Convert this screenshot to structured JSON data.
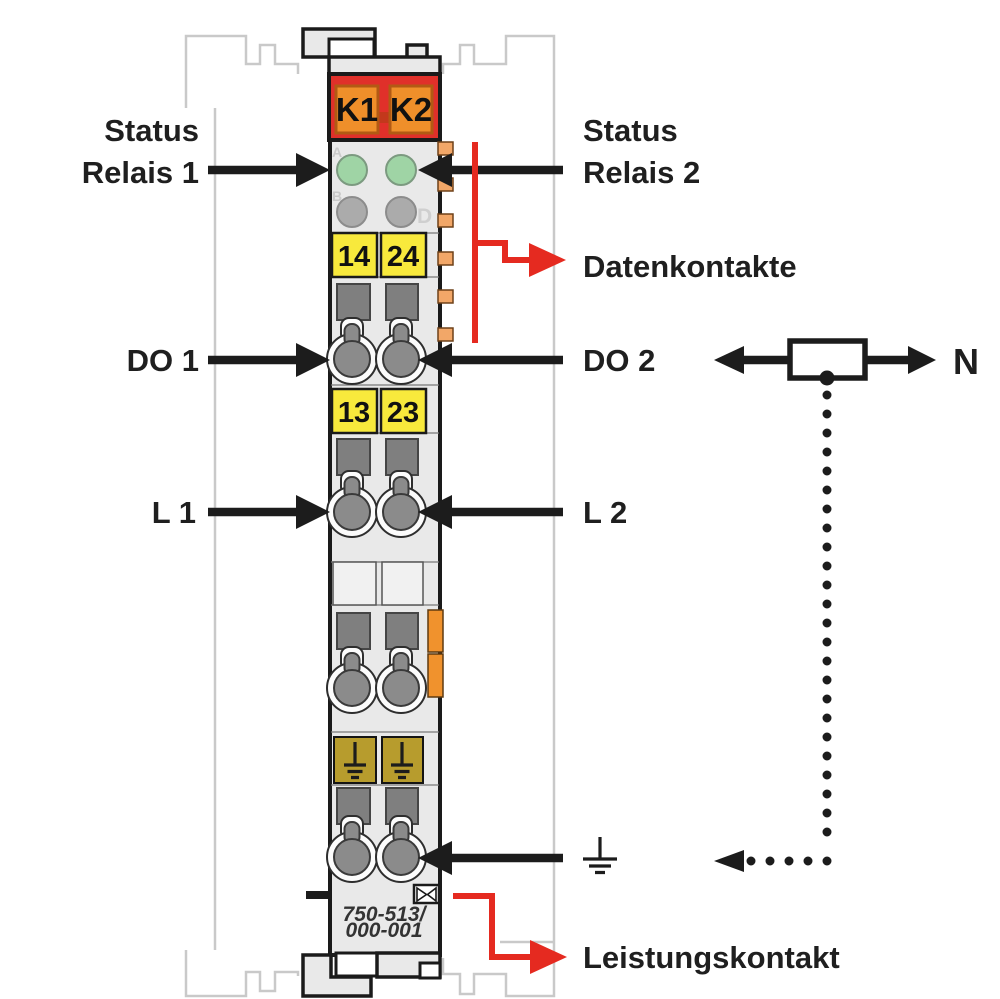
{
  "labels": {
    "left": {
      "status": "Status",
      "relais1": "Relais 1",
      "do1": "DO 1",
      "l1": "L 1"
    },
    "right": {
      "status": "Status",
      "relais2": "Relais 2",
      "datenkontakte": "Datenkontakte",
      "do2": "DO 2",
      "l2": "L 2",
      "neutral": "N",
      "leistungskontakt": "Leistungskontakt"
    }
  },
  "module": {
    "relays": [
      "K1",
      "K2"
    ],
    "led_letters": [
      "A",
      "B",
      "D"
    ],
    "terminals_top": [
      "14",
      "24"
    ],
    "terminals_mid": [
      "13",
      "23"
    ],
    "part_number": [
      "750-513/",
      "000-001"
    ]
  },
  "colors": {
    "red": "#e52a20",
    "band_red": "#e0302a",
    "relay_orange": "#ef8f2a",
    "tab_orange": "#f2a768",
    "latch_orange": "#f0922d",
    "yellow": "#f8e93c",
    "olive": "#b79c2d",
    "green_led": "#9fd4a5",
    "gray_led": "#ababab",
    "body_gray": "#e9e9e9",
    "black": "#1c1c1c",
    "ghost_gray": "#c9c9c9"
  }
}
